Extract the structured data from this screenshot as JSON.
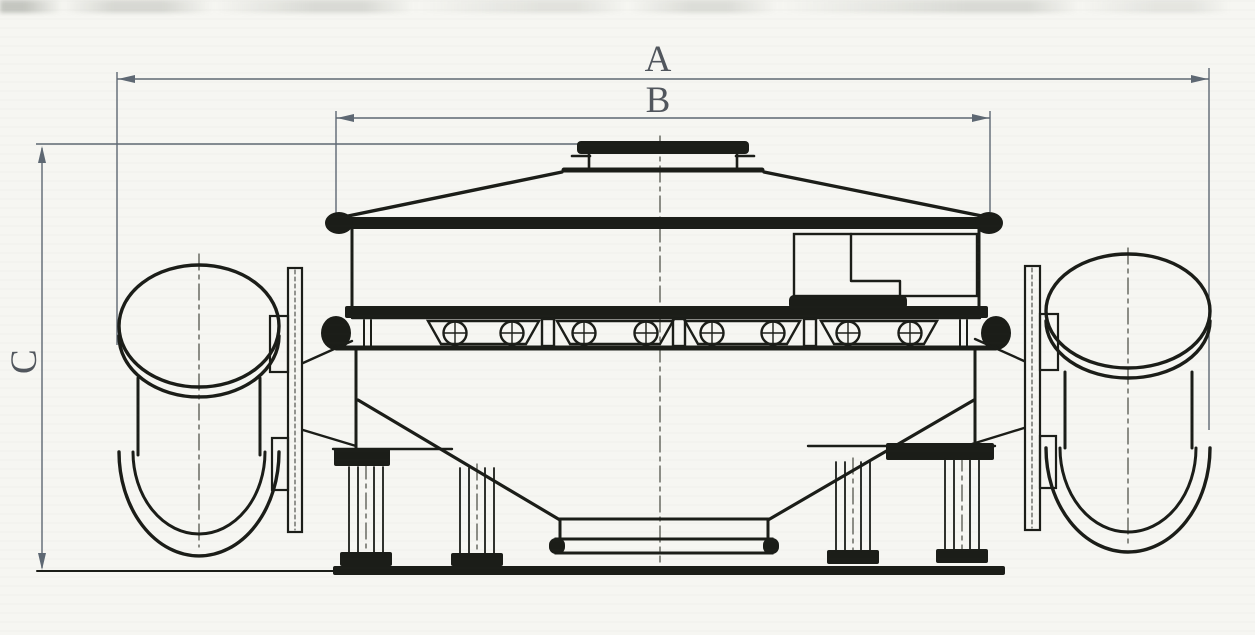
{
  "drawing": {
    "labels": {
      "dim_a": "A",
      "dim_b": "B",
      "dim_c": "C"
    },
    "colors": {
      "background": "#f6f6f2",
      "line": "#1b1d18",
      "dimension": "#5e6873",
      "centerline": "#45483f",
      "label": "#51565d"
    }
  }
}
